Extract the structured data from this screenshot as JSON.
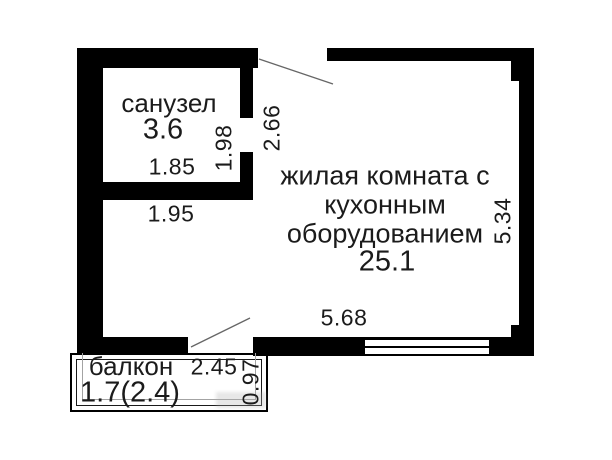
{
  "bathroom": {
    "name": "санузел",
    "area": "3.6",
    "width_label": "1.85",
    "depth_label": "1.98"
  },
  "entry": {
    "opening_label": "2.66"
  },
  "living": {
    "name_line1": "жилая комната с",
    "name_line2": "кухонным",
    "name_line3": "оборудованием",
    "area": "25.1",
    "height_label": "5.34",
    "width_label": "5.68",
    "passage_label": "1.95"
  },
  "balcony": {
    "name": "балкон",
    "area": "1.7(2.4)",
    "opening_label": "2.45",
    "depth_label": "0.97"
  },
  "colors": {
    "wall": "#000000",
    "text": "#1b1b1b",
    "swing_line": "#666666",
    "balcony_gray": "#a3a3a3",
    "background": "#ffffff"
  }
}
